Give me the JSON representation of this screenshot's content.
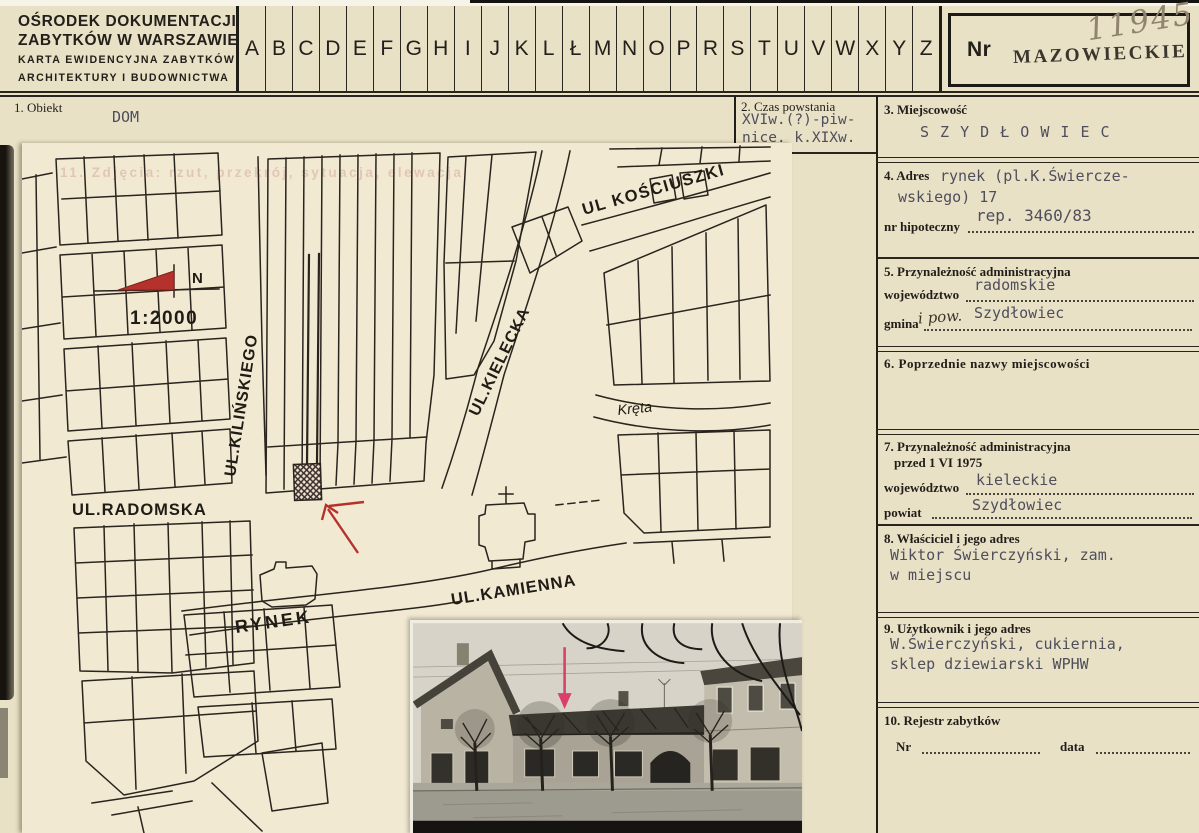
{
  "header": {
    "institution_line1": "OŚRODEK DOKUMENTACJI",
    "institution_line2": "ZABYTKÓW W WARSZAWIE",
    "card_type_line1": "KARTA EWIDENCYJNA ZABYTKÓW",
    "card_type_line2": "ARCHITEKTURY I BUDOWNICTWA",
    "alphabet": [
      "A",
      "B",
      "C",
      "D",
      "E",
      "F",
      "G",
      "H",
      "I",
      "J",
      "K",
      "L",
      "Ł",
      "M",
      "N",
      "O",
      "P",
      "R",
      "S",
      "T",
      "U",
      "V",
      "W",
      "X",
      "Y",
      "Z"
    ],
    "nr_label": "Nr",
    "voivodeship_stamp": "MAZOWIECKIE",
    "handwritten_number": "11945"
  },
  "fields": {
    "obiekt": {
      "label": "1. Obiekt",
      "value": "DOM"
    },
    "czas": {
      "label": "2. Czas powstania",
      "line1": "XVIw.(?)-piw-",
      "line2": "nice. k.XIXw."
    },
    "miejscowosc": {
      "label": "3. Miejscowość",
      "value": "S Z Y D Ł O W I E C"
    },
    "adres": {
      "label": "4. Adres",
      "line1": "rynek (pl.K.Świercze-",
      "line2": "wskiego) 17",
      "hipoteczny_label": "nr hipoteczny",
      "hipoteczny_value": "rep. 3460/83"
    },
    "admin": {
      "label": "5. Przynależność administracyjna",
      "wojewodztwo_label": "województwo",
      "wojewodztwo_value": "radomskie",
      "gmina_label": "gmina",
      "gmina_handwritten": "i pow.",
      "gmina_value": "Szydłowiec"
    },
    "poprzednie": {
      "label": "6. Poprzednie nazwy miejscowości"
    },
    "admin1975": {
      "label": "7. Przynależność administracyjna",
      "label2": "przed 1 VI 1975",
      "wojewodztwo_label": "województwo",
      "wojewodztwo_value": "kieleckie",
      "powiat_label": "powiat",
      "powiat_value": "Szydłowiec"
    },
    "wlasciciel": {
      "label": "8. Właściciel i jego adres",
      "line1": "Wiktor Świerczyński, zam.",
      "line2": "w miejscu"
    },
    "uzytkownik": {
      "label": "9. Użytkownik i jego adres",
      "line1": "W.Świerczyński, cukiernia,",
      "line2": "sklep dziewiarski WPHW"
    },
    "rejestr": {
      "label": "10. Rejestr zabytków",
      "nr_label": "Nr",
      "data_label": "data"
    }
  },
  "map": {
    "ghost_field_label": "11. Zdjęcia:  rzut,  przekrój,  sytuacja,  elewacja",
    "north_label": "N",
    "scale_label": "1:2000",
    "street_radomska": "UL.RADOMSKA",
    "street_kilinskiego": "UL.KILIŃSKIEGO",
    "street_kielecka": "UL.KIELECKA",
    "street_kosciuszki": "UL KOŚCIUSZKI",
    "street_kreta": "Kręta",
    "street_kamienna": "UL.KAMIENNA",
    "square_label": "RYNEK"
  },
  "colors": {
    "card_bg": "#e9e1c6",
    "map_sheet_bg": "#f2e9d3",
    "ink": "#29241d",
    "typed_ink": "#4e4e5c",
    "north_arrow_red": "#b5322c",
    "map_arrow_red": "#b5322c",
    "photo_arrow_pink": "#d8406b",
    "pencil": "#91846f"
  }
}
